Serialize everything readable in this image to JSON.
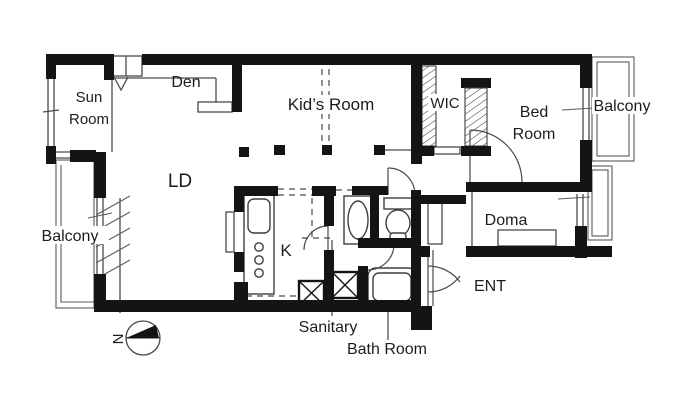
{
  "page": {
    "background": "#ffffff",
    "kind": "apartment floor plan drawing"
  },
  "colors": {
    "wall": "#141414",
    "line": "#4a4a4a",
    "text": "#1d1d1d",
    "background": "#ffffff"
  },
  "rooms": {
    "sun_room": {
      "label_line1": "Sun",
      "label_line2": "Room"
    },
    "den": {
      "label": "Den"
    },
    "kids_room": {
      "label": "Kid’s Room"
    },
    "wic": {
      "label": "WIC"
    },
    "bed_room": {
      "label_line1": "Bed",
      "label_line2": "Room"
    },
    "balcony_top_right": {
      "label": "Balcony"
    },
    "balcony_left": {
      "label": "Balcony"
    },
    "living_dining": {
      "label": "LD"
    },
    "kitchen": {
      "label": "K"
    },
    "doma": {
      "label": "Doma"
    },
    "entrance": {
      "label": "ENT"
    },
    "sanitary": {
      "label": "Sanitary"
    },
    "bath_room": {
      "label": "Bath Room"
    }
  },
  "compass": {
    "north_label": "N"
  }
}
